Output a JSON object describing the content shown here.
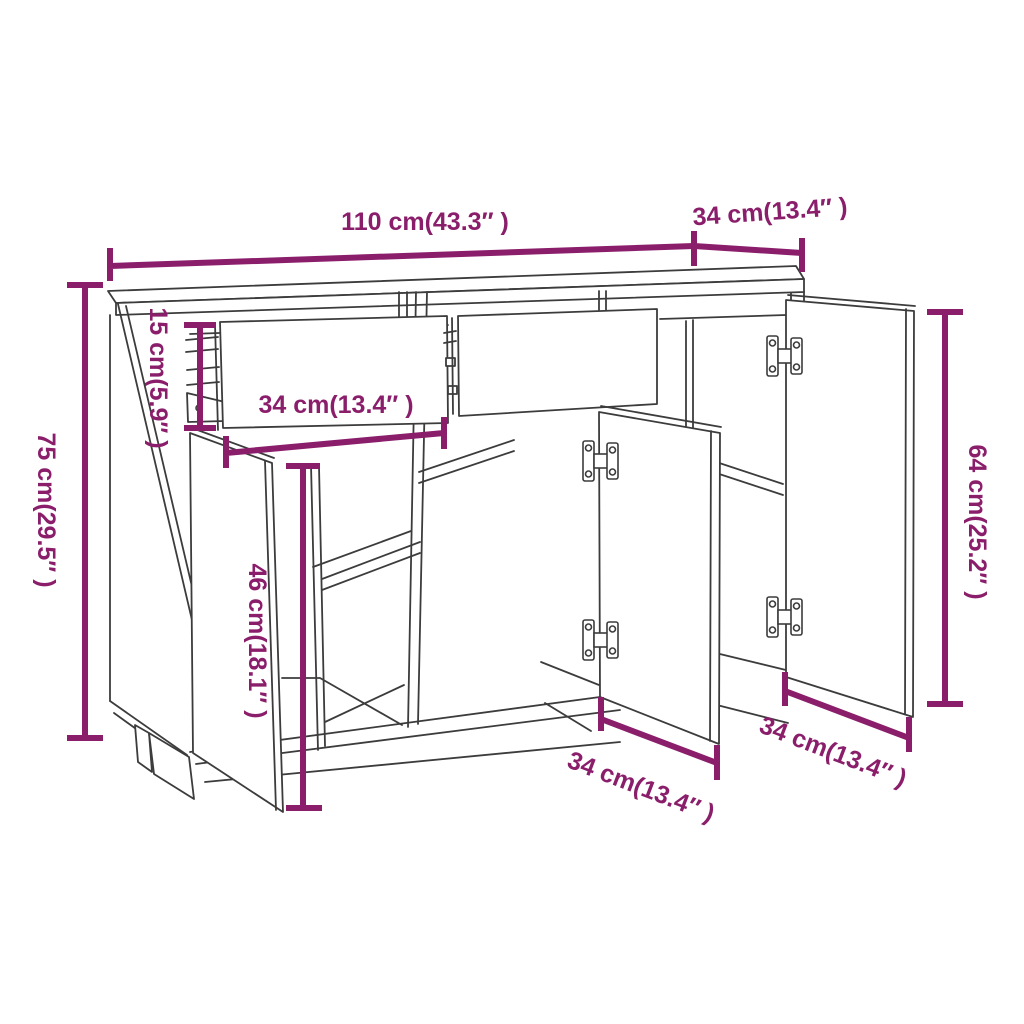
{
  "diagram": {
    "title": "Sideboard dimension drawing",
    "colors": {
      "dimension_accent": "#8a1e6b",
      "drawing_line": "#3c3c3c",
      "background": "#ffffff"
    },
    "dimensions": {
      "width_top": "110 cm(43.3″ )",
      "depth_top": "34 cm(13.4″ )",
      "height_total": "75 cm(29.5″ )",
      "drawer_height": "15 cm(5.9″ )",
      "drawer_width": "34 cm(13.4″ )",
      "door_height": "46 cm(18.1″ )",
      "door_panel_height": "64 cm(25.2″ )",
      "door_width_middle": "34 cm(13.4″ )",
      "door_width_right": "34 cm(13.4″ )"
    }
  }
}
